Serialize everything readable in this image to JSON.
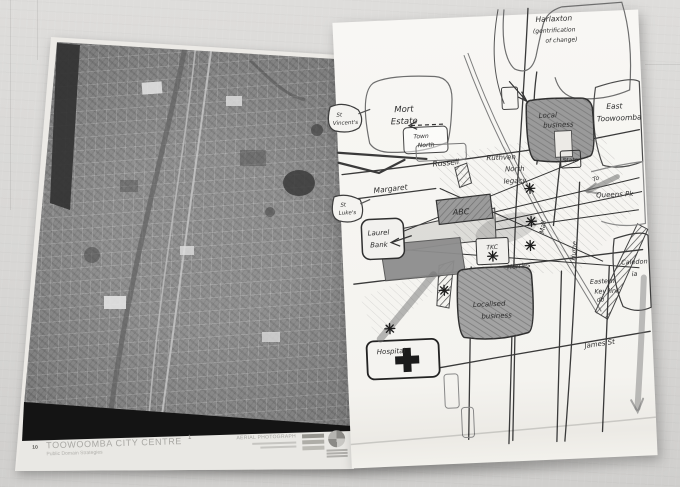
{
  "poster": {
    "badge": "10",
    "title": "TOOWOOMBA CITY CENTRE",
    "subtitle": "Public Domain Strategies",
    "sheet_number": "1",
    "photo_caption": "AERIAL PHOTOGRAPH"
  },
  "sketch": {
    "labels": {
      "harlaxton_1": "Harlaxton",
      "harlaxton_2": "(gentrification",
      "harlaxton_3": "of change)",
      "mort_estate_1": "Mort",
      "mort_estate_2": "Estate",
      "east_toowoomba_1": "East",
      "east_toowoomba_2": "Toowoomba",
      "st_vincents_1": "St",
      "st_vincents_2": "Vincent's",
      "st_lukes_1": "St",
      "st_lukes_2": "Luke's",
      "town_north_1": "Town",
      "town_north_2": "North",
      "russell": "Russell",
      "margaret": "Margaret",
      "abc": "ABC",
      "laurel_bank_1": "Laurel",
      "laurel_bank_2": "Bank",
      "ruthven_north_1": "Ruthven",
      "ruthven_north_2": "North",
      "ruthven_north_3": "legacy",
      "local_business_1": "Local",
      "local_business_2": "business",
      "state": "State",
      "to_queens_pk_1": "To",
      "to_queens_pk_2": "Queens Pk",
      "caledonia_1": "Caledon",
      "caledonia_2": "ia",
      "db": "db",
      "mall": "Mall",
      "hume": "Hume",
      "herries": "Herries",
      "tkc": "TKC",
      "localised_business_1": "Localised",
      "localised_business_2": "business",
      "eastern_key_link_1": "Eastern",
      "eastern_key_link_2": "Key link",
      "hospital": "Hospital",
      "james_st": "James St"
    }
  },
  "colors": {
    "wall": "#d8d7d5",
    "poster_paper": "#eceae6",
    "sketch_paper": "#f6f5f2",
    "photo_gray": "#858585",
    "ink": "#2d2d2d"
  }
}
